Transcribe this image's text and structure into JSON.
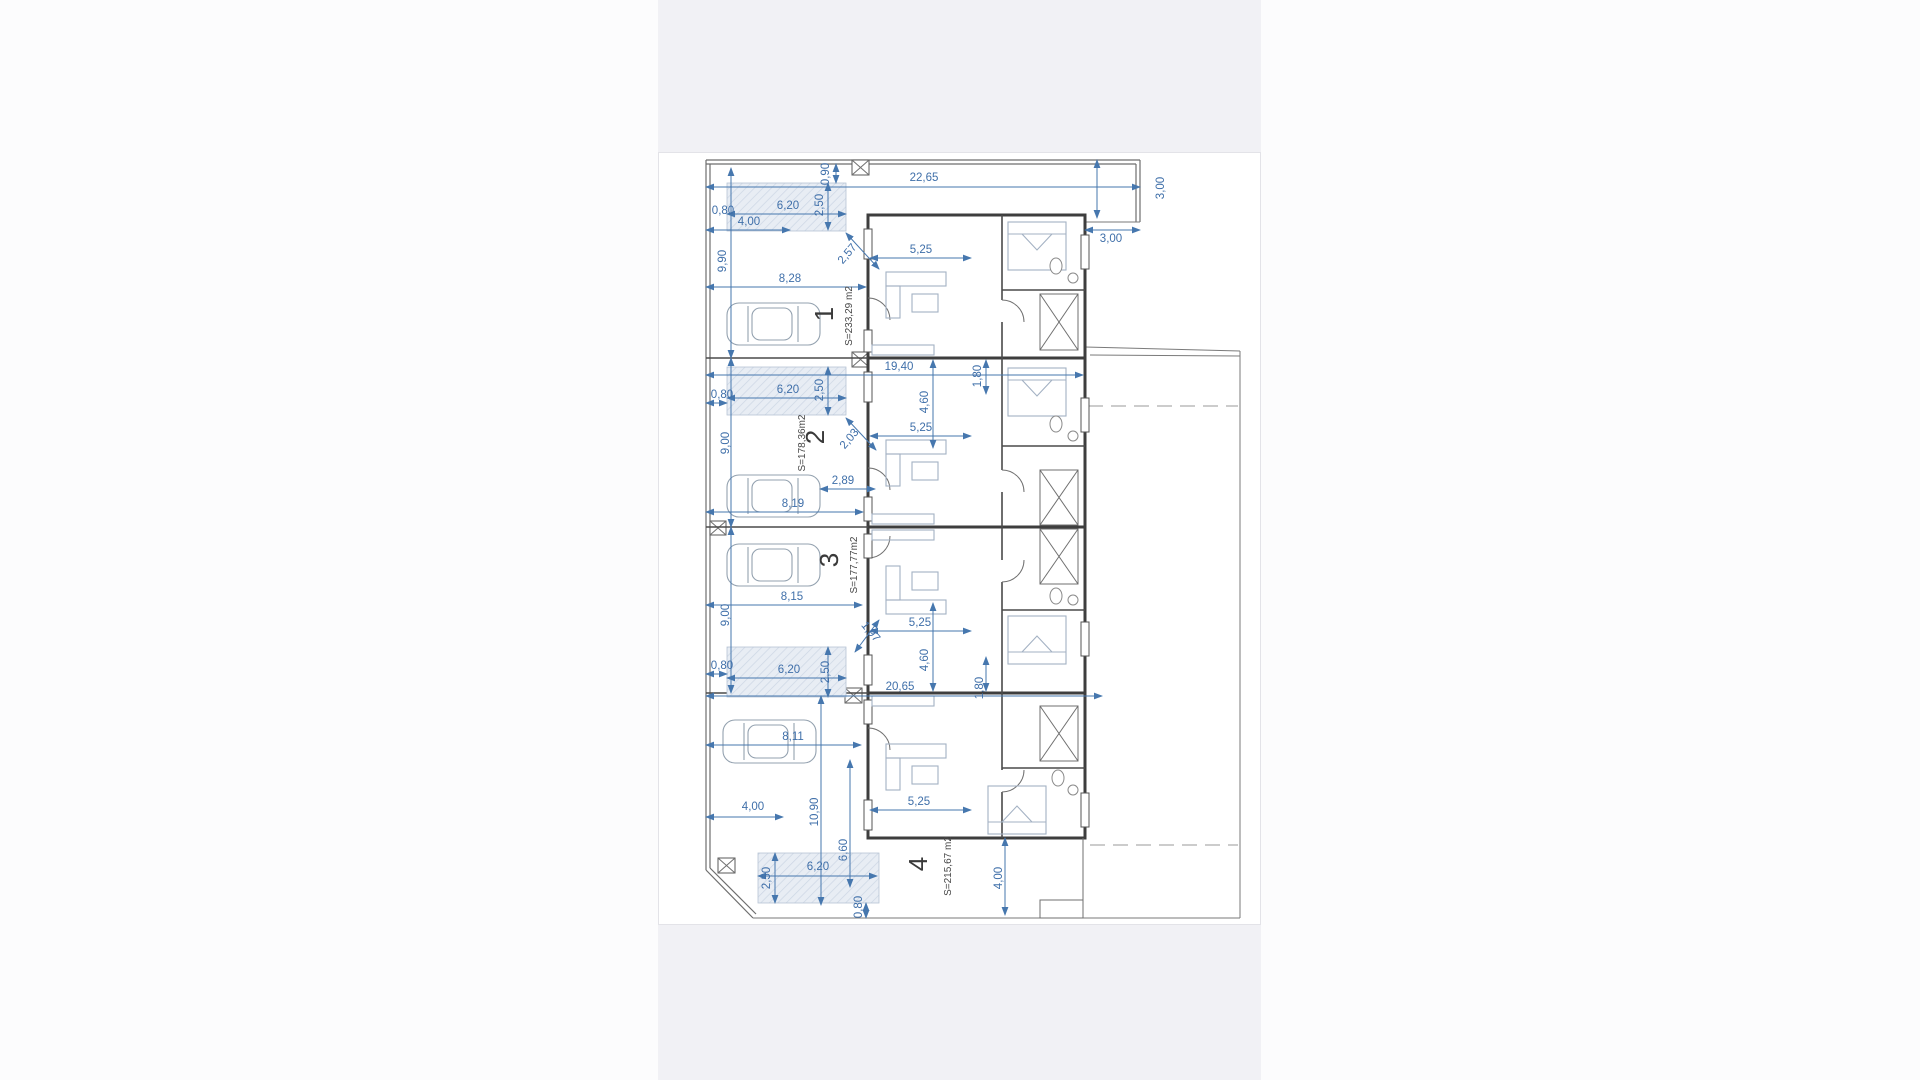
{
  "colors": {
    "band_bg": "#f1f1f5",
    "sheet_bg": "#ffffff",
    "dimension_blue": "#3f6fa9",
    "wall_gray": "#3e3e3e",
    "pool_fill": "#e8edf4"
  },
  "units": [
    {
      "number": "1",
      "area": "S=233,29 m2"
    },
    {
      "number": "2",
      "area": "S=178,36m2"
    },
    {
      "number": "3",
      "area": "S=177,77m2"
    },
    {
      "number": "4",
      "area": "S=215,67 m2"
    }
  ],
  "plan": {
    "labels": [
      {
        "text": "0,90",
        "x": 829,
        "y": 174,
        "r": -90,
        "kind": "dim"
      },
      {
        "text": "22,65",
        "x": 924,
        "y": 181,
        "kind": "dim"
      },
      {
        "text": "3,00",
        "x": 1164,
        "y": 188,
        "r": -90,
        "kind": "dim"
      },
      {
        "text": "3,00",
        "x": 1111,
        "y": 242,
        "kind": "dim"
      },
      {
        "text": "6,20",
        "x": 788,
        "y": 209,
        "kind": "dim"
      },
      {
        "text": "2,50",
        "x": 823,
        "y": 205,
        "r": -90,
        "kind": "dim"
      },
      {
        "text": "0,80",
        "x": 723,
        "y": 214,
        "kind": "dim"
      },
      {
        "text": "4,00",
        "x": 749,
        "y": 225,
        "kind": "dim"
      },
      {
        "text": "2,57",
        "x": 850,
        "y": 256,
        "r": -50,
        "kind": "dim"
      },
      {
        "text": "5,25",
        "x": 921,
        "y": 253,
        "kind": "dim"
      },
      {
        "text": "9,90",
        "x": 726,
        "y": 261,
        "r": -90,
        "kind": "dim"
      },
      {
        "text": "8,28",
        "x": 790,
        "y": 282,
        "kind": "dim"
      },
      {
        "text": "19,40",
        "x": 899,
        "y": 370,
        "kind": "dim"
      },
      {
        "text": "1,80",
        "x": 981,
        "y": 376,
        "r": -90,
        "kind": "dim"
      },
      {
        "text": "4,60",
        "x": 928,
        "y": 402,
        "r": -90,
        "kind": "dim"
      },
      {
        "text": "0,80",
        "x": 722,
        "y": 398,
        "kind": "dim"
      },
      {
        "text": "6,20",
        "x": 788,
        "y": 393,
        "kind": "dim"
      },
      {
        "text": "2,50",
        "x": 823,
        "y": 390,
        "r": -90,
        "kind": "dim"
      },
      {
        "text": "9,00",
        "x": 729,
        "y": 443,
        "r": -90,
        "kind": "dim"
      },
      {
        "text": "5,25",
        "x": 921,
        "y": 431,
        "kind": "dim"
      },
      {
        "text": "2,03",
        "x": 852,
        "y": 441,
        "r": -50,
        "kind": "dim"
      },
      {
        "text": "2,89",
        "x": 843,
        "y": 484,
        "kind": "dim"
      },
      {
        "text": "8,19",
        "x": 793,
        "y": 507,
        "kind": "dim"
      },
      {
        "text": "9,00",
        "x": 729,
        "y": 615,
        "r": -90,
        "kind": "dim"
      },
      {
        "text": "8,15",
        "x": 792,
        "y": 600,
        "kind": "dim"
      },
      {
        "text": "1,97",
        "x": 868,
        "y": 634,
        "r": 50,
        "kind": "dim"
      },
      {
        "text": "5,25",
        "x": 920,
        "y": 626,
        "kind": "dim"
      },
      {
        "text": "4,60",
        "x": 928,
        "y": 660,
        "r": -90,
        "kind": "dim"
      },
      {
        "text": "0,80",
        "x": 722,
        "y": 669,
        "kind": "dim"
      },
      {
        "text": "6,20",
        "x": 789,
        "y": 673,
        "kind": "dim"
      },
      {
        "text": "2,50",
        "x": 829,
        "y": 672,
        "r": -90,
        "kind": "dim"
      },
      {
        "text": "20,65",
        "x": 900,
        "y": 690,
        "kind": "dim"
      },
      {
        "text": "1,80",
        "x": 983,
        "y": 688,
        "r": -90,
        "kind": "dim"
      },
      {
        "text": "8,11",
        "x": 793,
        "y": 740,
        "kind": "dim"
      },
      {
        "text": "4,00",
        "x": 753,
        "y": 810,
        "kind": "dim"
      },
      {
        "text": "10,90",
        "x": 818,
        "y": 812,
        "r": -90,
        "kind": "dim"
      },
      {
        "text": "6,60",
        "x": 847,
        "y": 850,
        "r": -90,
        "kind": "dim"
      },
      {
        "text": "2,50",
        "x": 770,
        "y": 878,
        "r": -90,
        "kind": "dim"
      },
      {
        "text": "6,20",
        "x": 818,
        "y": 870,
        "kind": "dim"
      },
      {
        "text": "0,80",
        "x": 862,
        "y": 907,
        "r": -90,
        "kind": "dim"
      },
      {
        "text": "5,25",
        "x": 919,
        "y": 805,
        "kind": "dim"
      },
      {
        "text": "4,00",
        "x": 1002,
        "y": 878,
        "r": -90,
        "kind": "dim"
      },
      {
        "text": "1",
        "x": 833,
        "y": 314,
        "r": -90,
        "kind": "unit"
      },
      {
        "text": "S=233,29 m2",
        "x": 852,
        "y": 316,
        "r": -90,
        "kind": "area"
      },
      {
        "text": "2",
        "x": 824,
        "y": 437,
        "r": -90,
        "kind": "unit"
      },
      {
        "text": "S=178,36m2",
        "x": 805,
        "y": 443,
        "r": -90,
        "kind": "area"
      },
      {
        "text": "3",
        "x": 838,
        "y": 560,
        "r": -90,
        "kind": "unit"
      },
      {
        "text": "S=177,77m2",
        "x": 857,
        "y": 565,
        "r": -90,
        "kind": "area"
      },
      {
        "text": "4",
        "x": 927,
        "y": 864,
        "r": -90,
        "kind": "unit"
      },
      {
        "text": "S=215,67 m2",
        "x": 951,
        "y": 866,
        "r": -90,
        "kind": "area"
      }
    ]
  }
}
